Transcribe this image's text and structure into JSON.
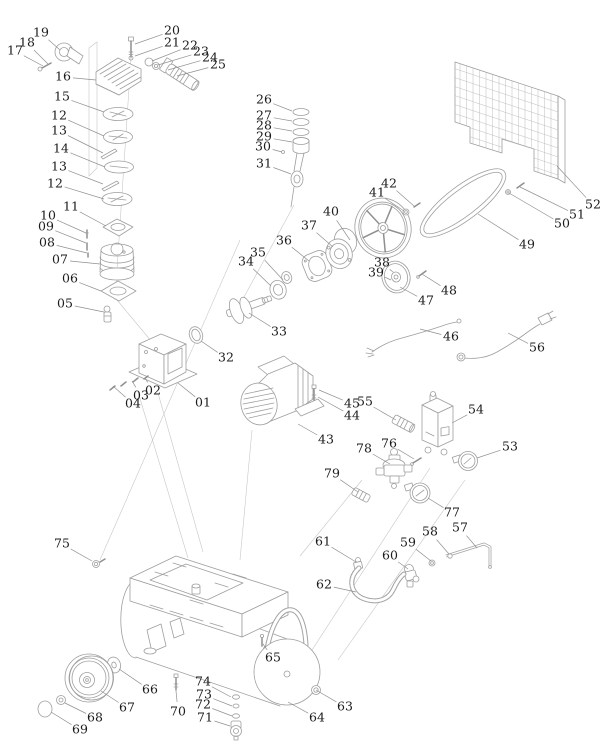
{
  "diagram": {
    "type": "exploded-parts-diagram",
    "subject": "air-compressor",
    "colors": {
      "background": "#ffffff",
      "part_line": "#9e9e9e",
      "leader_line": "#909090",
      "label_text": "#1c1c1c"
    },
    "label_font_size": 12.5,
    "labels": [
      {
        "n": "17",
        "x": 15,
        "y": 51,
        "tx": 43,
        "ty": 66
      },
      {
        "n": "18",
        "x": 27,
        "y": 43,
        "tx": 48,
        "ty": 64
      },
      {
        "n": "19",
        "x": 41,
        "y": 33,
        "tx": 60,
        "ty": 50
      },
      {
        "n": "16",
        "x": 63,
        "y": 77,
        "tx": 96,
        "ty": 80
      },
      {
        "n": "15",
        "x": 62,
        "y": 97,
        "tx": 104,
        "ty": 112
      },
      {
        "n": "12",
        "x": 59,
        "y": 116,
        "tx": 104,
        "ty": 136
      },
      {
        "n": "13",
        "x": 59,
        "y": 131,
        "tx": 103,
        "ty": 153
      },
      {
        "n": "14",
        "x": 61,
        "y": 149,
        "tx": 105,
        "ty": 167
      },
      {
        "n": "13",
        "x": 59,
        "y": 167,
        "tx": 103,
        "ty": 184
      },
      {
        "n": "12",
        "x": 55,
        "y": 184,
        "tx": 104,
        "ty": 199
      },
      {
        "n": "11",
        "x": 71,
        "y": 207,
        "tx": 106,
        "ty": 226
      },
      {
        "n": "10",
        "x": 48,
        "y": 216,
        "tx": 86,
        "ty": 233
      },
      {
        "n": "09",
        "x": 46,
        "y": 227,
        "tx": 86,
        "ty": 243
      },
      {
        "n": "08",
        "x": 47,
        "y": 243,
        "tx": 87,
        "ty": 253
      },
      {
        "n": "07",
        "x": 60,
        "y": 260,
        "tx": 100,
        "ty": 264
      },
      {
        "n": "06",
        "x": 70,
        "y": 279,
        "tx": 101,
        "ty": 291
      },
      {
        "n": "05",
        "x": 65,
        "y": 304,
        "tx": 104,
        "ty": 312
      },
      {
        "n": "20",
        "x": 172,
        "y": 31,
        "tx": 135,
        "ty": 44
      },
      {
        "n": "21",
        "x": 172,
        "y": 43,
        "tx": 135,
        "ty": 56
      },
      {
        "n": "22",
        "x": 190,
        "y": 46,
        "tx": 152,
        "ty": 61
      },
      {
        "n": "23",
        "x": 201,
        "y": 52,
        "tx": 158,
        "ty": 65
      },
      {
        "n": "24",
        "x": 210,
        "y": 58,
        "tx": 168,
        "ty": 70
      },
      {
        "n": "25",
        "x": 218,
        "y": 65,
        "tx": 177,
        "ty": 76
      },
      {
        "n": "26",
        "x": 264,
        "y": 100,
        "tx": 292,
        "ty": 111
      },
      {
        "n": "27",
        "x": 264,
        "y": 116,
        "tx": 292,
        "ty": 121
      },
      {
        "n": "28",
        "x": 264,
        "y": 126,
        "tx": 292,
        "ty": 131
      },
      {
        "n": "29",
        "x": 264,
        "y": 137,
        "tx": 292,
        "ty": 142
      },
      {
        "n": "30",
        "x": 263,
        "y": 147,
        "tx": 282,
        "ty": 152
      },
      {
        "n": "31",
        "x": 264,
        "y": 164,
        "tx": 291,
        "ty": 174
      },
      {
        "n": "01",
        "x": 203,
        "y": 403,
        "tx": 178,
        "ty": 383
      },
      {
        "n": "02",
        "x": 153,
        "y": 391,
        "tx": 145,
        "ty": 378
      },
      {
        "n": "03",
        "x": 141,
        "y": 396,
        "tx": 132,
        "ty": 381
      },
      {
        "n": "04",
        "x": 133,
        "y": 404,
        "tx": 113,
        "ty": 386
      },
      {
        "n": "32",
        "x": 226,
        "y": 358,
        "tx": 201,
        "ty": 341
      },
      {
        "n": "33",
        "x": 279,
        "y": 332,
        "tx": 249,
        "ty": 313
      },
      {
        "n": "34",
        "x": 246,
        "y": 262,
        "tx": 271,
        "ty": 286
      },
      {
        "n": "35",
        "x": 258,
        "y": 253,
        "tx": 283,
        "ty": 280
      },
      {
        "n": "36",
        "x": 284,
        "y": 241,
        "tx": 309,
        "ty": 261
      },
      {
        "n": "37",
        "x": 309,
        "y": 226,
        "tx": 333,
        "ty": 247
      },
      {
        "n": "38",
        "x": 382,
        "y": 263,
        "tx": 393,
        "ty": 272
      },
      {
        "n": "39",
        "x": 376,
        "y": 273,
        "tx": 391,
        "ty": 280
      },
      {
        "n": "40",
        "x": 331,
        "y": 212,
        "tx": 350,
        "ty": 240
      },
      {
        "n": "41",
        "x": 377,
        "y": 193,
        "tx": 404,
        "ty": 211
      },
      {
        "n": "42",
        "x": 389,
        "y": 184,
        "tx": 414,
        "ty": 206
      },
      {
        "n": "43",
        "x": 326,
        "y": 440,
        "tx": 298,
        "ty": 424
      },
      {
        "n": "44",
        "x": 352,
        "y": 416,
        "tx": 318,
        "ty": 397
      },
      {
        "n": "45",
        "x": 352,
        "y": 404,
        "tx": 319,
        "ty": 390
      },
      {
        "n": "55",
        "x": 365,
        "y": 402,
        "tx": 396,
        "ty": 420
      },
      {
        "n": "46",
        "x": 451,
        "y": 337,
        "tx": 420,
        "ty": 329
      },
      {
        "n": "47",
        "x": 426,
        "y": 301,
        "tx": 400,
        "ty": 287
      },
      {
        "n": "48",
        "x": 449,
        "y": 291,
        "tx": 422,
        "ty": 274
      },
      {
        "n": "49",
        "x": 527,
        "y": 245,
        "tx": 478,
        "ty": 214
      },
      {
        "n": "50",
        "x": 562,
        "y": 224,
        "tx": 509,
        "ty": 193
      },
      {
        "n": "51",
        "x": 577,
        "y": 215,
        "tx": 520,
        "ty": 187
      },
      {
        "n": "52",
        "x": 593,
        "y": 205,
        "tx": 557,
        "ty": 166
      },
      {
        "n": "53",
        "x": 510,
        "y": 447,
        "tx": 477,
        "ty": 458
      },
      {
        "n": "54",
        "x": 476,
        "y": 410,
        "tx": 452,
        "ty": 423
      },
      {
        "n": "56",
        "x": 537,
        "y": 348,
        "tx": 508,
        "ty": 333
      },
      {
        "n": "57",
        "x": 460,
        "y": 528,
        "tx": 477,
        "ty": 548
      },
      {
        "n": "58",
        "x": 430,
        "y": 532,
        "tx": 449,
        "ty": 554
      },
      {
        "n": "59",
        "x": 408,
        "y": 543,
        "tx": 431,
        "ty": 561
      },
      {
        "n": "60",
        "x": 390,
        "y": 556,
        "tx": 408,
        "ty": 569
      },
      {
        "n": "61",
        "x": 323,
        "y": 542,
        "tx": 356,
        "ty": 562
      },
      {
        "n": "62",
        "x": 324,
        "y": 585,
        "tx": 356,
        "ty": 592
      },
      {
        "n": "63",
        "x": 345,
        "y": 707,
        "tx": 316,
        "ty": 690
      },
      {
        "n": "64",
        "x": 317,
        "y": 718,
        "tx": 288,
        "ty": 702
      },
      {
        "n": "65",
        "x": 273,
        "y": 658,
        "tx": 263,
        "ty": 644
      },
      {
        "n": "66",
        "x": 150,
        "y": 690,
        "tx": 119,
        "ty": 669
      },
      {
        "n": "67",
        "x": 127,
        "y": 708,
        "tx": 101,
        "ty": 691
      },
      {
        "n": "68",
        "x": 95,
        "y": 718,
        "tx": 65,
        "ty": 703
      },
      {
        "n": "69",
        "x": 80,
        "y": 730,
        "tx": 51,
        "ty": 712
      },
      {
        "n": "70",
        "x": 178,
        "y": 712,
        "tx": 176,
        "ty": 691
      },
      {
        "n": "71",
        "x": 205,
        "y": 718,
        "tx": 230,
        "ty": 726
      },
      {
        "n": "72",
        "x": 203,
        "y": 705,
        "tx": 232,
        "ty": 716
      },
      {
        "n": "73",
        "x": 204,
        "y": 695,
        "tx": 232,
        "ty": 706
      },
      {
        "n": "74",
        "x": 203,
        "y": 682,
        "tx": 231,
        "ty": 697
      },
      {
        "n": "75",
        "x": 62,
        "y": 544,
        "tx": 92,
        "ty": 561
      },
      {
        "n": "76",
        "x": 389,
        "y": 444,
        "tx": 414,
        "ty": 459
      },
      {
        "n": "77",
        "x": 452,
        "y": 513,
        "tx": 428,
        "ty": 498
      },
      {
        "n": "78",
        "x": 364,
        "y": 449,
        "tx": 390,
        "ty": 464
      },
      {
        "n": "79",
        "x": 332,
        "y": 474,
        "tx": 358,
        "ty": 492
      }
    ]
  }
}
